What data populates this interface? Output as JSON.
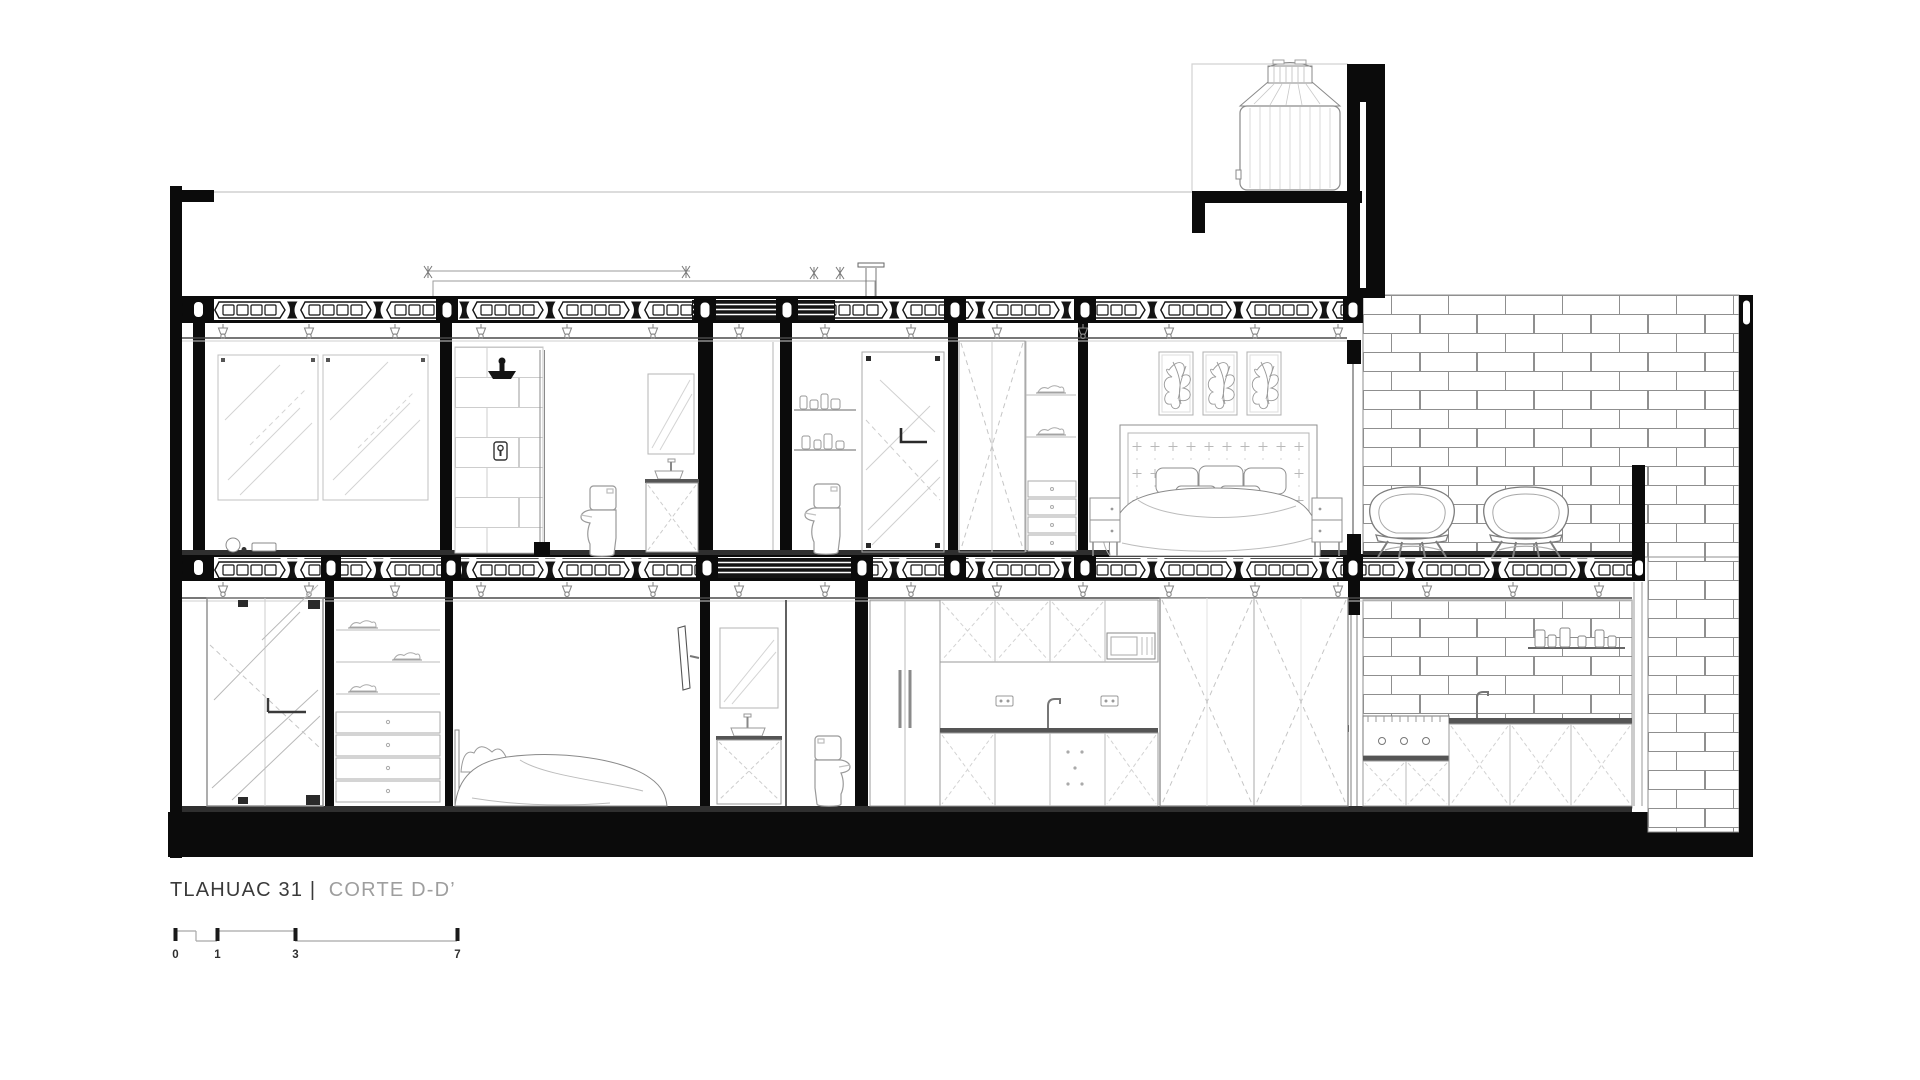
{
  "title": {
    "primary": "TLAHUAC 31 |",
    "secondary": "CORTE D-D’"
  },
  "scale_bar": {
    "labels": [
      "0",
      "1",
      "3",
      "7"
    ]
  },
  "colors": {
    "ink": "#111111",
    "furniture_line": "#9a9a9a",
    "brick_line": "#8f8f8f",
    "tile_line": "#cdcdcd",
    "title_primary": "#3a3a3a",
    "title_secondary": "#9e9e9e",
    "background": "#ffffff"
  }
}
